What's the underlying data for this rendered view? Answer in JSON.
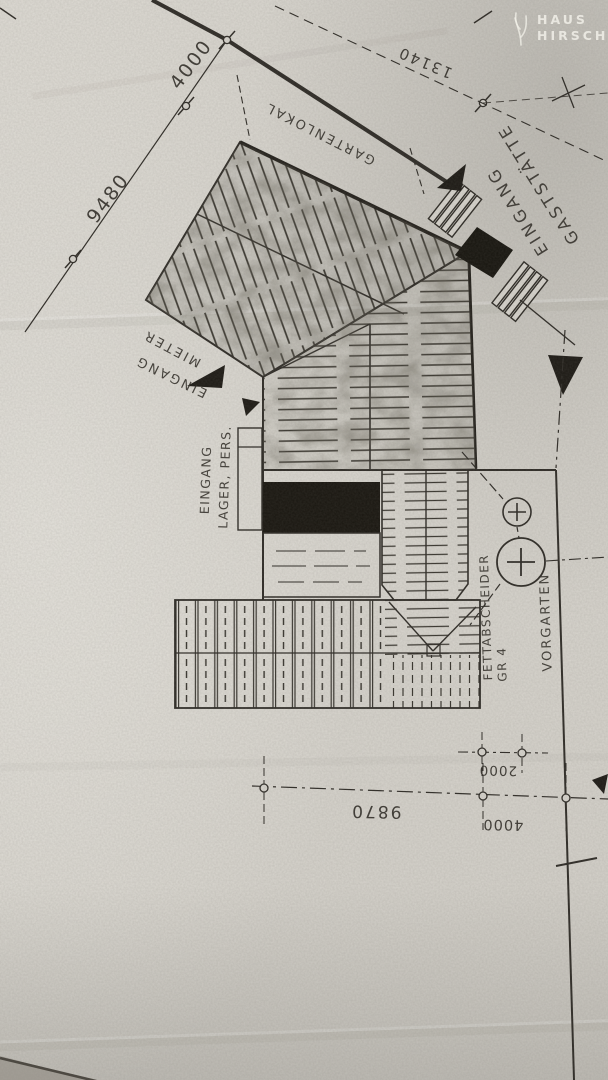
{
  "watermark": {
    "icon": "antler-icon",
    "line1": "HAUS",
    "line2": "HIRSCH"
  },
  "labels": {
    "gartenlokal": "GARTENLOKAL",
    "eingang_gast_1": "EINGANG",
    "eingang_gast_2": "GASTSTÄTTE",
    "eingang_mieter_1": "EINGANG",
    "eingang_mieter_2": "MIETER",
    "eingang_lager_1": "EINGANG",
    "eingang_lager_2": "LAGER, PERS.",
    "fettabscheider_1": "FETTABSCHEIDER",
    "fettabscheider_2": "GR 4",
    "vorgarten": "VORGARTEN"
  },
  "dimensions": {
    "top_segment": "4000",
    "left_total": "9480",
    "street": "13140",
    "bottom_main": "9870",
    "bottom_offset": "2000",
    "bottom_side": "4000"
  },
  "colors": {
    "paper": "#d8d5ce",
    "ink": "#2e2b26",
    "black_fill": "#1a1712",
    "watermark_text": "#f3f1ea"
  }
}
